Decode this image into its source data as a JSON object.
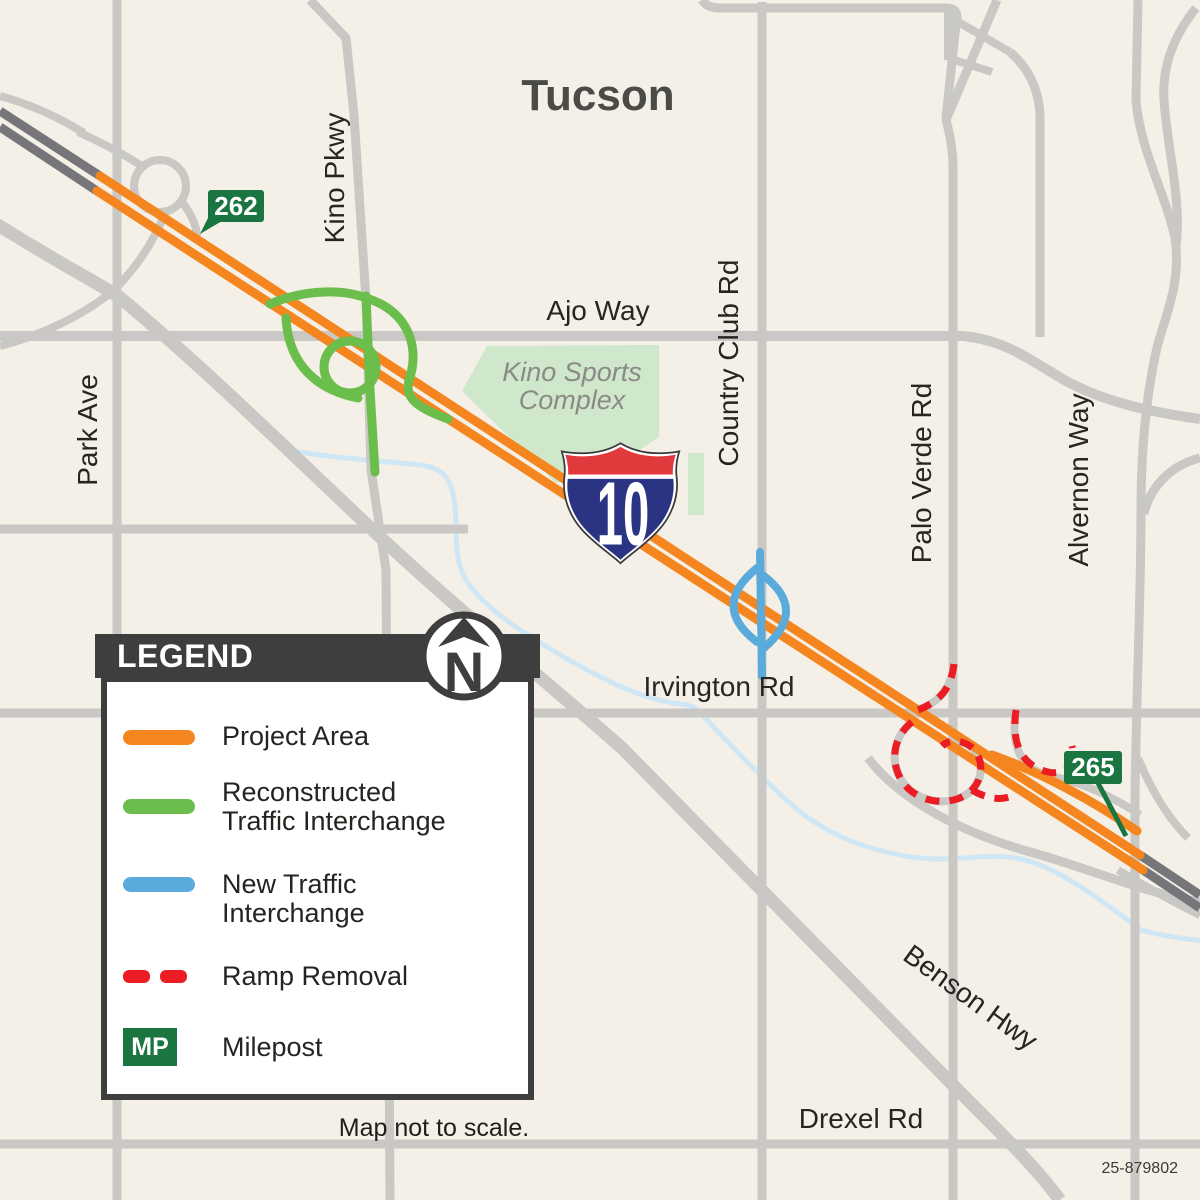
{
  "title": "Tucson",
  "map": {
    "city_label": "Tucson",
    "road_labels": [
      {
        "id": "park-ave",
        "text": "Park Ave"
      },
      {
        "id": "kino-pkwy",
        "text": "Kino Pkwy"
      },
      {
        "id": "ajo-way",
        "text": "Ajo Way"
      },
      {
        "id": "country-club-rd",
        "text": "Country Club Rd"
      },
      {
        "id": "palo-verde-rd",
        "text": "Palo Verde Rd"
      },
      {
        "id": "alvernon-way",
        "text": "Alvernon Way"
      },
      {
        "id": "irvington-rd",
        "text": "Irvington Rd"
      },
      {
        "id": "benson-hwy",
        "text": "Benson Hwy"
      },
      {
        "id": "drexel-rd",
        "text": "Drexel Rd"
      }
    ],
    "areas": {
      "kino_sports_complex": {
        "line1": "Kino Sports",
        "line2": "Complex"
      }
    },
    "highway_shield": {
      "interstate": "10"
    },
    "mileposts": [
      {
        "value": "262"
      },
      {
        "value": "265"
      }
    ]
  },
  "legend": {
    "title": "LEGEND",
    "items": [
      {
        "label": "Project Area",
        "swatch": "orange-line"
      },
      {
        "line1": "Reconstructed",
        "line2": "Traffic Interchange",
        "swatch": "green-line"
      },
      {
        "line1": "New Traffic",
        "line2": "Interchange",
        "swatch": "blue-line"
      },
      {
        "label": "Ramp Removal",
        "swatch": "red-dashed-line"
      },
      {
        "label": "Milepost",
        "swatch": "milepost-badge",
        "badge_text": "MP"
      }
    ]
  },
  "compass": {
    "north_label": "N"
  },
  "footer": {
    "scale_note": "Map not to scale.",
    "project_number": "25-879802"
  },
  "colors": {
    "background": "#F4F0E7",
    "road_gray": "#C9C8C5",
    "freeway_dark_gray": "#76767A",
    "project_orange": "#F5861F",
    "reconstructed_green": "#6CBE4C",
    "new_interchange_blue": "#5AABDC",
    "ramp_removal_red": "#EC1C24",
    "milepost_green": "#1B7540",
    "shield_blue": "#2B3383",
    "shield_red": "#E03A3C",
    "park_green": "#CFE7CA",
    "creek_blue": "#CFE7F5"
  }
}
